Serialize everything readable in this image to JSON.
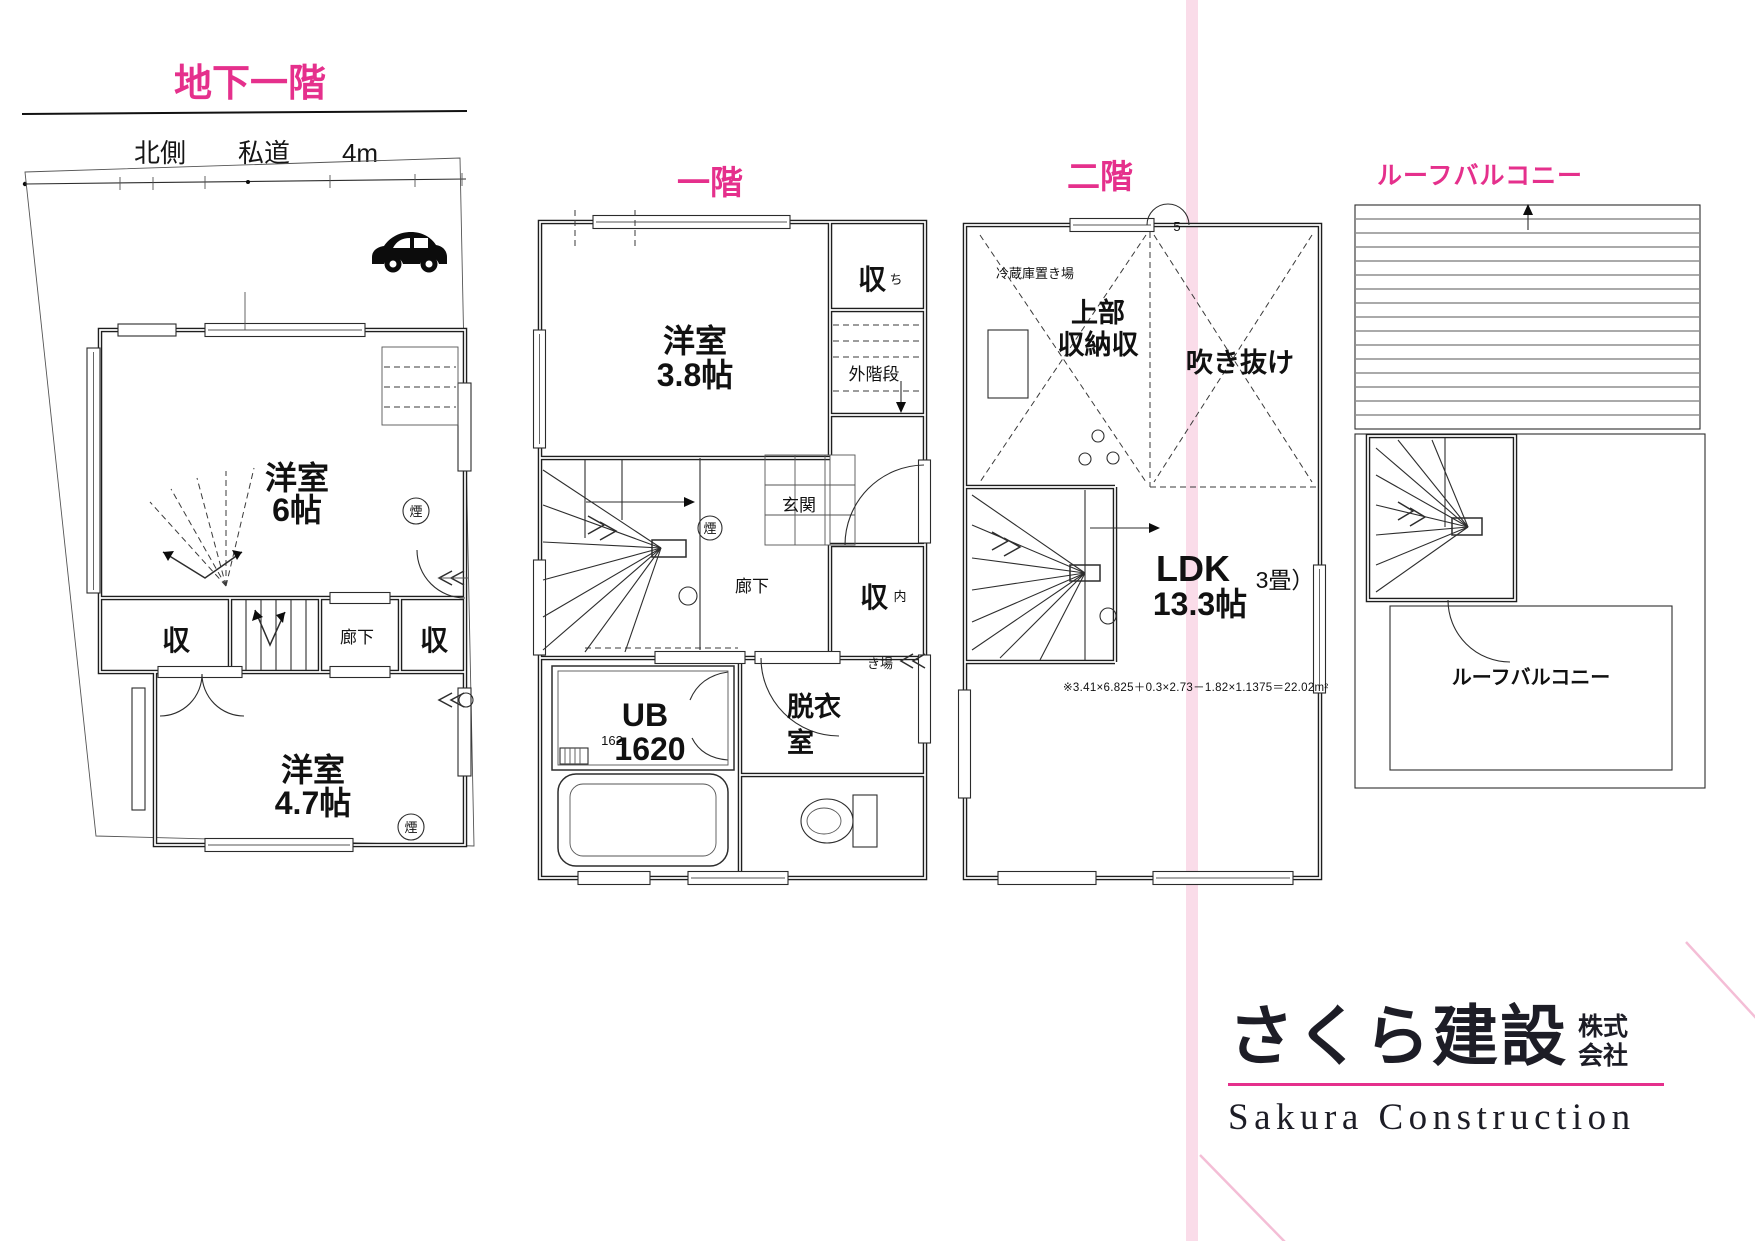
{
  "palette": {
    "pink": "#e5308c",
    "stripe": "#fadce9",
    "diag": "#f4bed6"
  },
  "b1": {
    "title": "地下一階",
    "road_label": "北側　　私道　　4m",
    "room_upper_name": "洋室",
    "room_upper_size": "6帖",
    "closet": "収",
    "corridor": "廊下",
    "room_lower_name": "洋室",
    "room_lower_size": "4.7帖",
    "smoke": "煙"
  },
  "f1": {
    "title": "一階",
    "room_name": "洋室",
    "room_size": "3.8帖",
    "closet_top": "収",
    "closet_top_note": "ち",
    "ext_stairs": "外階段",
    "entrance": "玄関",
    "corridor": "廊下",
    "closet_mid": "収",
    "closet_mid_note": "内",
    "kiba": "き場",
    "smoke": "煙",
    "ub_name": "UB",
    "ub_size": "1620",
    "ub_note": "162",
    "dressing_l1": "脱衣",
    "dressing_l2": "室"
  },
  "f2": {
    "title": "二階",
    "fridge": "冷蔵庫置き場",
    "storage_l1": "上部",
    "storage_l2": "収納収",
    "void_label": "吹き抜け",
    "door_note": "5",
    "ldk_name": "LDK",
    "ldk_size": "13.3帖",
    "tatami_note": "3畳）",
    "formula": "※3.41×6.825＋0.3×2.73－1.82×1.1375＝22.02m²"
  },
  "roof": {
    "title": "ルーフバルコニー",
    "label": "ルーフバルコニー"
  },
  "logo": {
    "name": "さくら建設",
    "suffix_l1": "株式",
    "suffix_l2": "会社",
    "name_en": "Sakura Construction"
  }
}
